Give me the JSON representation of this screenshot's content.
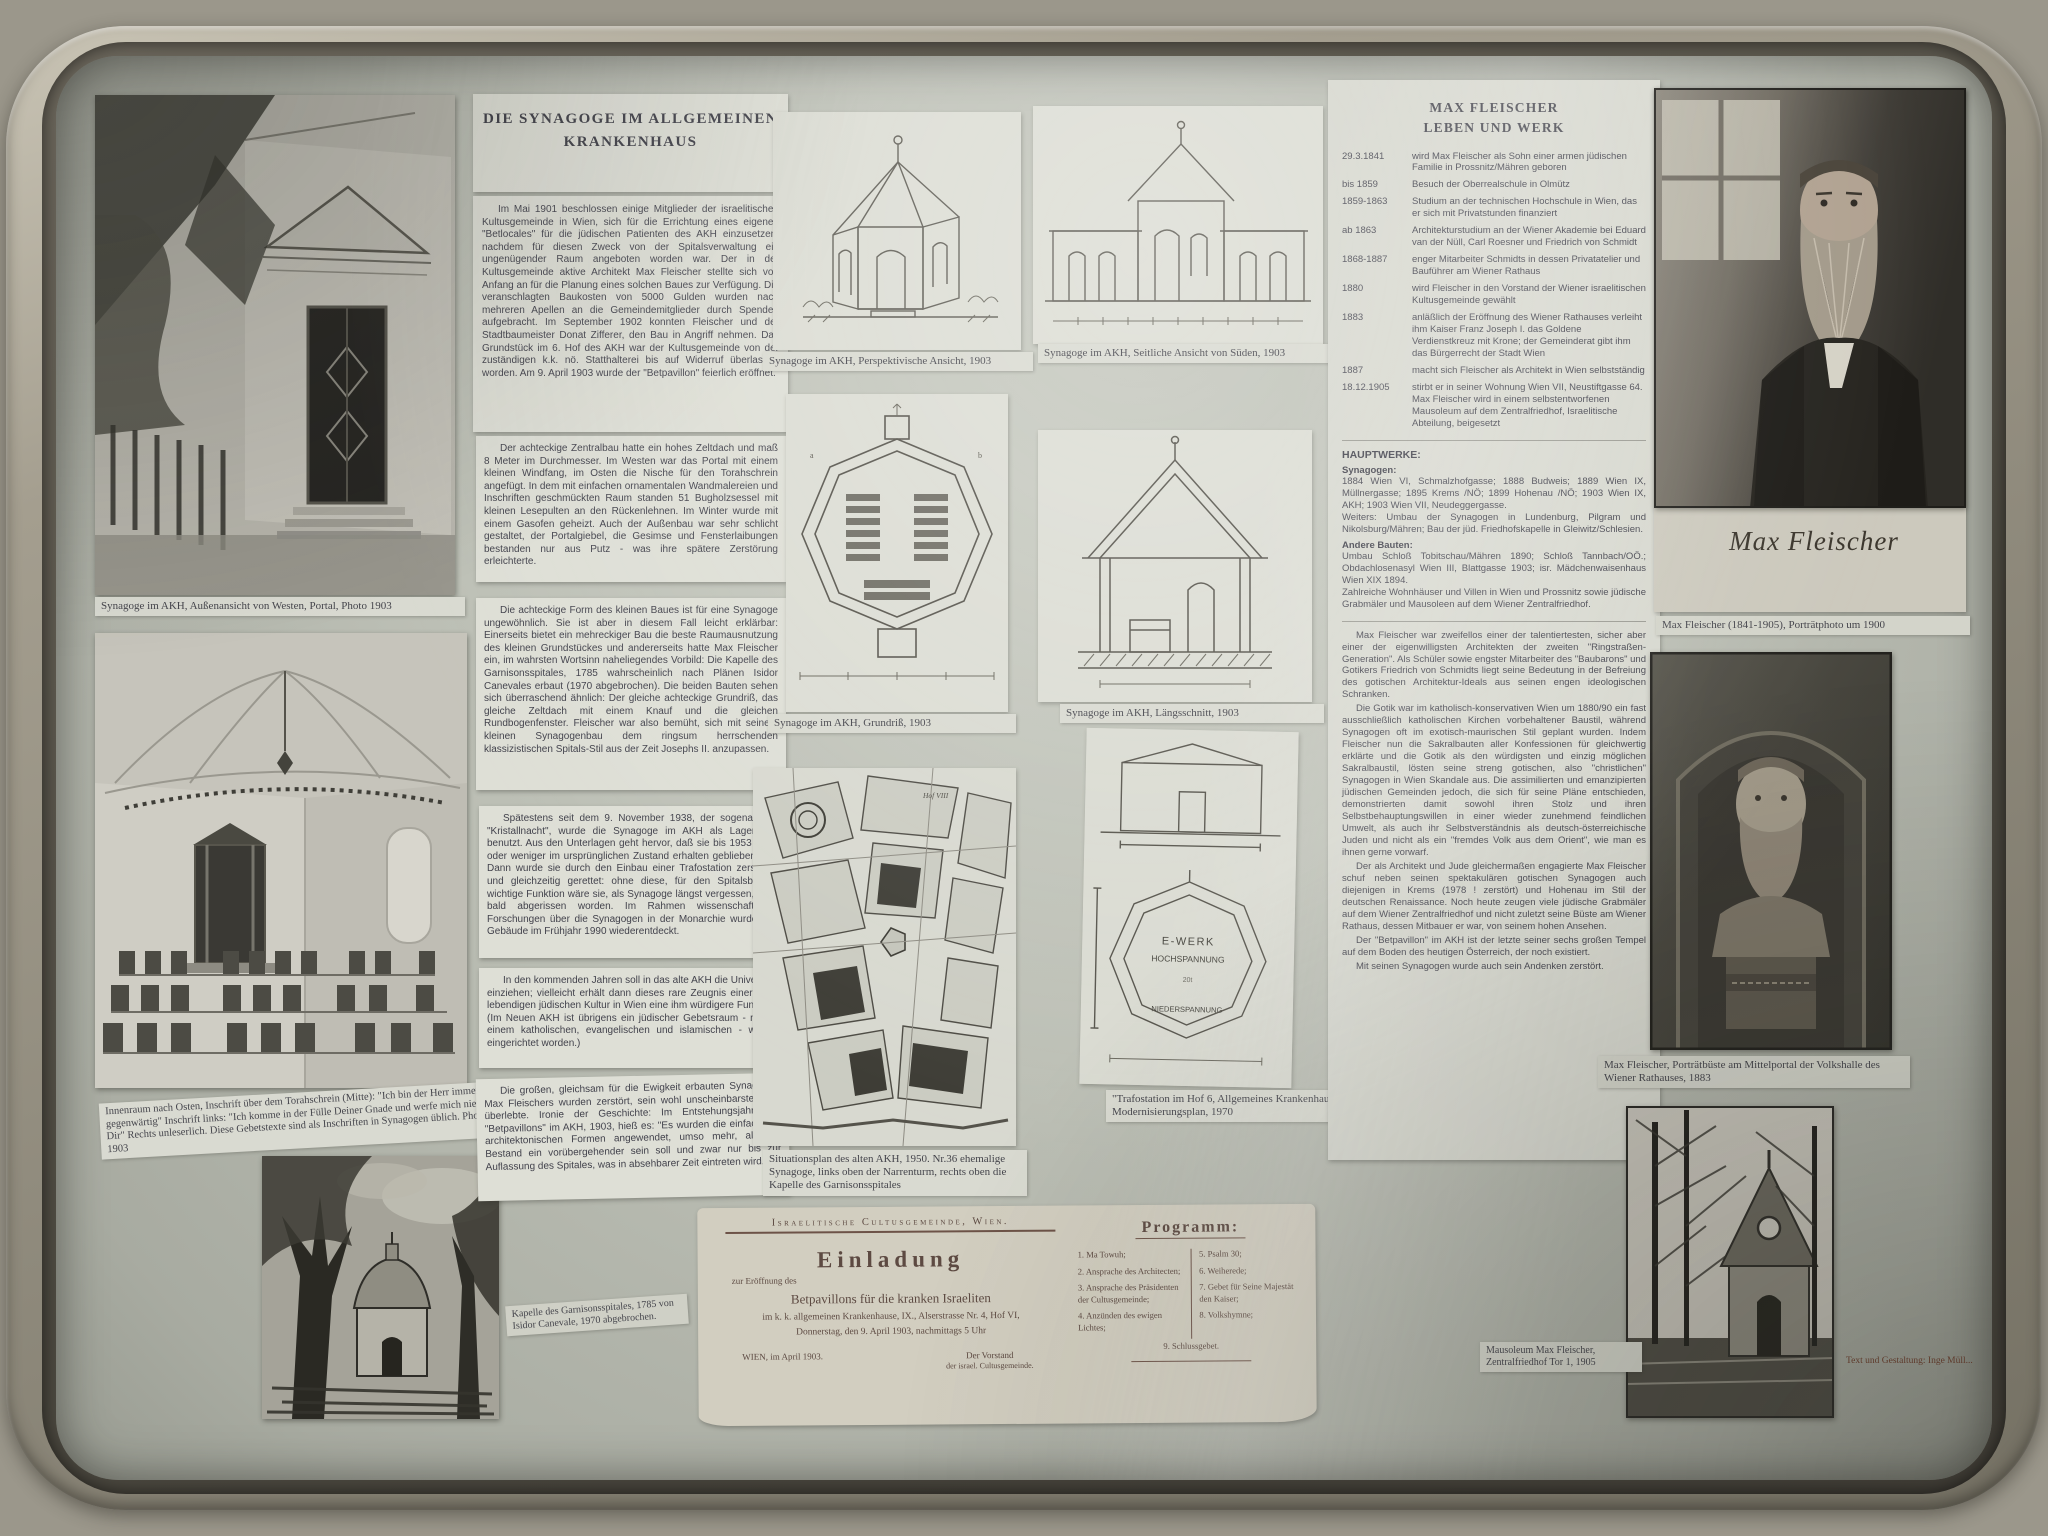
{
  "article": {
    "title": "DIE SYNAGOGE IM ALLGEMEINEN KRANKENHAUS",
    "paragraphs": [
      "Im Mai 1901 beschlossen einige Mitglieder der israelitischen Kultusgemeinde in Wien, sich für die Errichtung eines eigenen \"Betlocales\" für die jüdischen Patienten des AKH einzusetzen, nachdem für diesen Zweck von der Spitalsverwaltung ein ungenügender Raum angeboten worden war. Der in der Kultusgemeinde aktive Architekt Max Fleischer stellte sich von Anfang an für die Planung eines solchen Baues zur Verfügung. Die veranschlagten Baukosten von 5000 Gulden wurden nach mehreren Apellen an die Gemeindemitglieder durch Spenden aufgebracht. Im September 1902 konnten Fleischer und der Stadtbaumeister Donat Zifferer, den Bau in Angriff nehmen. Das Grundstück im 6. Hof des AKH war der Kultusgemeinde von der zuständigen k.k. nö. Statthalterei bis auf Widerruf überlassen worden. Am 9. April 1903 wurde der \"Betpavillon\" feierlich eröffnet.",
      "Der achteckige Zentralbau hatte ein hohes Zeltdach und maß 8 Meter im Durchmesser. Im Westen war das Portal mit einem kleinen Windfang, im Osten die Nische für den Torahschrein angefügt. In dem mit einfachen ornamentalen Wandmalereien und Inschriften geschmückten Raum standen 51 Bugholzsessel mit kleinen Lesepulten an den Rückenlehnen. Im Winter wurde mit einem Gasofen geheizt. Auch der Außenbau war sehr schlicht gestaltet, der Portalgiebel, die Gesimse und Fensterlaibungen bestanden nur aus Putz - was ihre spätere Zerstörung erleichterte.",
      "Die achteckige Form des kleinen Baues ist für eine Synagoge ungewöhnlich. Sie ist aber in diesem Fall leicht erklärbar: Einerseits bietet ein mehreckiger Bau die beste Raumausnutzung des kleinen Grundstückes und andererseits hatte Max Fleischer ein, im wahrsten Wortsinn naheliegendes Vorbild: Die Kapelle des Garnisonsspitales, 1785 wahrscheinlich nach Plänen Isidor Canevales erbaut (1970 abgebrochen). Die beiden Bauten sehen sich überraschend ähnlich: Der gleiche achteckige Grundriß, das gleiche Zeltdach mit einem Knauf und die gleichen Rundbogenfenster. Fleischer war also bemüht, sich mit seinem kleinen Synagogenbau dem ringsum herrschenden klassizistischen Spitals-Stil aus der Zeit Josephs II. anzupassen.",
      "Spätestens seit dem 9. November 1938, der sogenannten \"Kristallnacht\", wurde die Synagoge im AKH als Lagerraum benutzt. Aus den Unterlagen geht hervor, daß sie bis 1953 mehr oder weniger im ursprünglichen Zustand erhalten geblieben war. Dann wurde sie durch den Einbau einer Trafostation zerstört - und gleichzeitig gerettet: ohne diese, für den Spitalsbetrieb wichtige Funktion wäre sie, als Synagoge längst vergessen, wohl bald abgerissen worden. Im Rahmen wissenschaftlicher Forschungen über die Synagogen in der Monarchie wurde das Gebäude im Frühjahr 1990 wiederentdeckt.",
      "In den kommenden Jahren soll in das alte AKH die Universität einziehen; vielleicht erhält dann dieses rare Zeugnis einer einst lebendigen jüdischen Kultur in Wien eine ihm würdigere Funktion. (Im Neuen AKH ist übrigens ein jüdischer Gebetsraum - neben einem katholischen, evangelischen und islamischen - wieder eingerichtet worden.)",
      "Die großen, gleichsam für die Ewigkeit erbauten Synagogen Max Fleischers wurden zerstört, sein wohl unscheinbarster Bau überlebte. Ironie der Geschichte: Im Entstehungsjahr des \"Betpavillons\" im AKH, 1903, hieß es: \"Es wurden die einfachsten architektonischen Formen angewendet, umso mehr, als der Bestand ein vorübergehender sein soll und zwar nur bis zur Auflassung des Spitales, was in absehbarer Zeit eintreten wird.\""
    ]
  },
  "bio": {
    "title1": "MAX FLEISCHER",
    "title2": "LEBEN UND WERK",
    "timeline": [
      {
        "y": "29.3.1841",
        "t": "wird Max Fleischer als Sohn einer armen jüdischen Familie in Prossnitz/Mähren geboren"
      },
      {
        "y": "bis 1859",
        "t": "Besuch der Oberrealschule in Olmütz"
      },
      {
        "y": "1859-1863",
        "t": "Studium an der technischen Hochschule in Wien, das er sich mit Privatstunden finanziert"
      },
      {
        "y": "ab 1863",
        "t": "Architekturstudium an der Wiener Akademie bei Eduard van der Nüll, Carl Roesner und Friedrich von Schmidt"
      },
      {
        "y": "1868-1887",
        "t": "enger Mitarbeiter Schmidts in dessen Privatatelier und Bauführer am Wiener Rathaus"
      },
      {
        "y": "1880",
        "t": "wird Fleischer in den Vorstand der Wiener israelitischen Kultusgemeinde gewählt"
      },
      {
        "y": "1883",
        "t": "anläßlich der Eröffnung des Wiener Rathauses verleiht ihm Kaiser Franz Joseph I. das Goldene Verdienstkreuz mit Krone; der Gemeinderat gibt ihm das Bürgerrecht der Stadt Wien"
      },
      {
        "y": "1887",
        "t": "macht sich Fleischer als Architekt in Wien selbstständig"
      },
      {
        "y": "18.12.1905",
        "t": "stirbt er in seiner Wohnung Wien VII, Neustiftgasse 64. Max Fleischer wird in einem selbstentworfenen Mausoleum auf dem Zentralfriedhof, Israelitische Abteilung, beigesetzt"
      }
    ],
    "hauptwerke": "HAUPTWERKE:",
    "syn_h": "Synagogen:",
    "syn": "1884 Wien VI, Schmalzhofgasse; 1888 Budweis; 1889 Wien IX, Müllnergasse; 1895 Krems /NÖ; 1899 Hohenau /NÖ; 1903 Wien IX, AKH; 1903 Wien VII, Neudeggergasse.",
    "weiters": "Weiters: Umbau der Synagogen in Lundenburg, Pilgram und Nikolsburg/Mähren; Bau der jüd. Friedhofskapelle in Gleiwitz/Schlesien.",
    "andere_h": "Andere Bauten:",
    "andere": "Umbau Schloß Tobitschau/Mähren 1890; Schloß Tannbach/OÖ.; Obdachlosenasyl Wien III, Blattgasse 1903; isr. Mädchenwaisenhaus Wien XIX 1894.",
    "zahlreiche": "Zahlreiche Wohnhäuser und Villen in Wien und Prossnitz sowie jüdische Grabmäler und Mausoleen auf dem Wiener Zentralfriedhof.",
    "essay": [
      "Max Fleischer war zweifellos einer der talentiertesten, sicher aber einer der eigenwilligsten Architekten der zweiten \"Ringstraßen-Generation\". Als Schüler sowie engster Mitarbeiter des \"Baubarons\" und Gotikers Friedrich von Schmidts liegt seine Bedeutung in der Befreiung des gotischen Architektur-Ideals aus seinen engen ideologischen Schranken.",
      "Die Gotik war im katholisch-konservativen Wien um 1880/90 ein fast ausschließlich katholischen Kirchen vorbehaltener Baustil, während Synagogen oft im exotisch-maurischen Stil geplant wurden. Indem Fleischer nun die Sakralbauten aller Konfessionen für gleichwertig erklärte und die Gotik als den würdigsten und einzig möglichen Sakralbaustil, lösten seine streng gotischen, also \"christlichen\" Synagogen in Wien Skandale aus. Die assimilierten und emanzipierten jüdischen Gemeinden jedoch, die sich für seine Pläne entschieden, demonstrierten damit sowohl ihren Stolz und ihren Selbstbehauptungswillen in einer wieder zunehmend feindlichen Umwelt, als auch ihr Selbstverständnis als deutsch-österreichische Juden und nicht als ein \"fremdes Volk aus dem Orient\", wie man es ihnen gerne vorwarf.",
      "Der als Architekt und Jude gleichermaßen engagierte Max Fleischer schuf neben seinen spektakulären gotischen Synagogen auch diejenigen in Krems (1978 ! zerstört) und Hohenau im Stil der deutschen Renaissance. Noch heute zeugen viele jüdische Grabmäler auf dem Wiener Zentralfriedhof und nicht zuletzt seine Büste am Wiener Rathaus, dessen Mitbauer er war, von seinem hohen Ansehen.",
      "Der \"Betpavillon\" im AKH ist der letzte seiner sechs großen Tempel auf dem Boden des heutigen Österreich, der noch existiert.",
      "Mit seinen Synagogen wurde auch sein Andenken zerstört."
    ]
  },
  "captions": {
    "portal": "Synagoge im AKH, Außenansicht von Westen, Portal, Photo 1903",
    "interior": "Innenraum nach Osten, Inschrift über dem Torahschrein (Mitte): \"Ich bin der Herr immer gegenwärtig\" Inschrift links: \"Ich komme in der Fülle Deiner Gnade und werfe mich nieder vor Dir\" Rechts unleserlich. Diese Gebetstexte sind als Inschriften in Synagogen üblich. Photo 1903",
    "perspective": "Synagoge im AKH, Perspektivische Ansicht, 1903",
    "side": "Synagoge im AKH, Seitliche Ansicht von Süden, 1903",
    "grundriss": "Synagoge im AKH, Grundriß, 1903",
    "schnitt": "Synagoge im AKH, Längsschnitt, 1903",
    "map": "Situationsplan des alten AKH, 1950. Nr.36 ehemalige Synagoge, links oben der Narrenturm, rechts oben die Kapelle des Garnisonsspitales",
    "trafo": "\"Trafostation im Hof 6, Allgemeines Krankenhaus\", Modernisierungsplan, 1970",
    "portrait": "Max Fleischer (1841-1905), Porträtphoto um 1900",
    "bust": "Max Fleischer, Porträtbüste am Mittelportal der Volkshalle des Wiener Rathauses, 1883",
    "mausoleum": "Mausoleum Max Fleischer, Zentralfriedhof Tor 1, 1905",
    "kapelle": "Kapelle des Garnisonsspitales, 1785 von Isidor Canevale, 1970 abgebrochen."
  },
  "portrait_signature": "Max Fleischer",
  "invitation": {
    "org": "Israelitische Cultusgemeinde, Wien.",
    "title": "Einladung",
    "line1": "zur Eröffnung des",
    "line2": "Betpavillons für die kranken Israeliten",
    "line3": "im k. k. allgemeinen Krankenhause, IX., Alserstrasse Nr. 4, Hof VI,",
    "line4": "Donnerstag, den 9. April 1903, nachmittags 5 Uhr",
    "place_date": "WIEN, im April 1903.",
    "sig1": "Der Vorstand",
    "sig2": "der israel. Cultusgemeinde.",
    "prog_title": "Programm:",
    "col1": [
      "1. Ma Towuh;",
      "2. Ansprache des Architecten;",
      "3. Ansprache des Präsidenten der Cultusgemeinde;",
      "4. Anzünden des ewigen Lichtes;"
    ],
    "col2": [
      "5. Psalm 30;",
      "6. Weiherede;",
      "7. Gebet für Seine Majestät den Kaiser;",
      "8. Volkshymne;"
    ],
    "last": "9. Schlussgebet."
  },
  "plan": {
    "ewerk": "E-WERK",
    "hoch": "HOCHSPANNUNG",
    "nieder": "NIEDERSPANNUNG"
  },
  "credit": "Text und Gestaltung: Inge Müll..."
}
